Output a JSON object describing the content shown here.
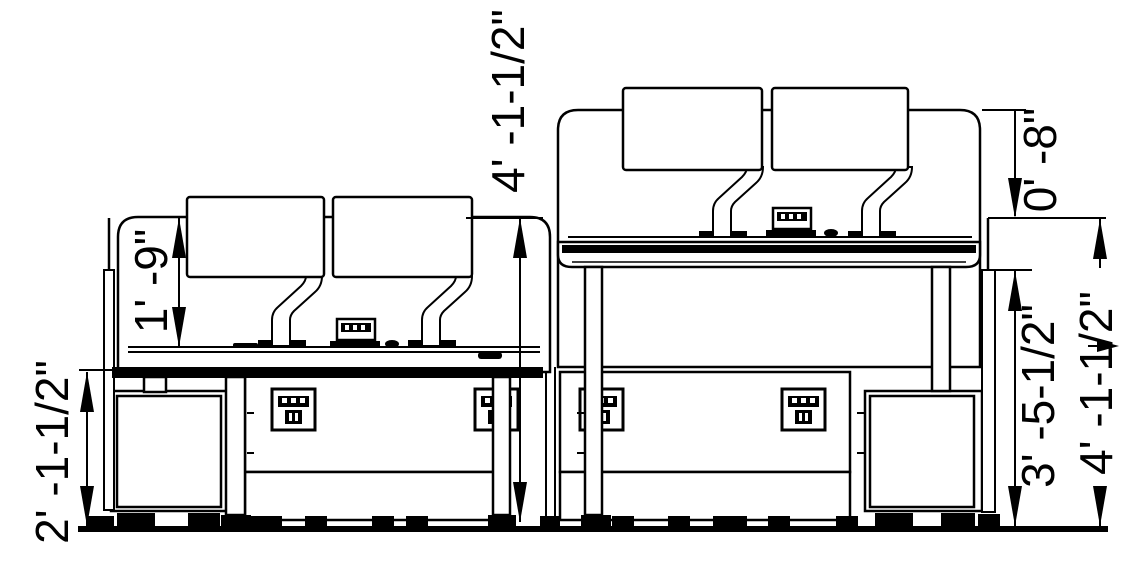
{
  "page": {
    "type": "furniture-elevation-drawing",
    "background": "#ffffff",
    "line_color": "#000000"
  },
  "dimensions": {
    "left_desk_height": "2' -1-1/2\"",
    "left_screen_above_desk": "1' -9\"",
    "left_overall_height": "4' -1-1/2\"",
    "right_screen_top_offset": "0' -8\"",
    "right_screen_height": "3' -5-1/2\"",
    "right_overall_height": "4' -1-1/2\""
  }
}
